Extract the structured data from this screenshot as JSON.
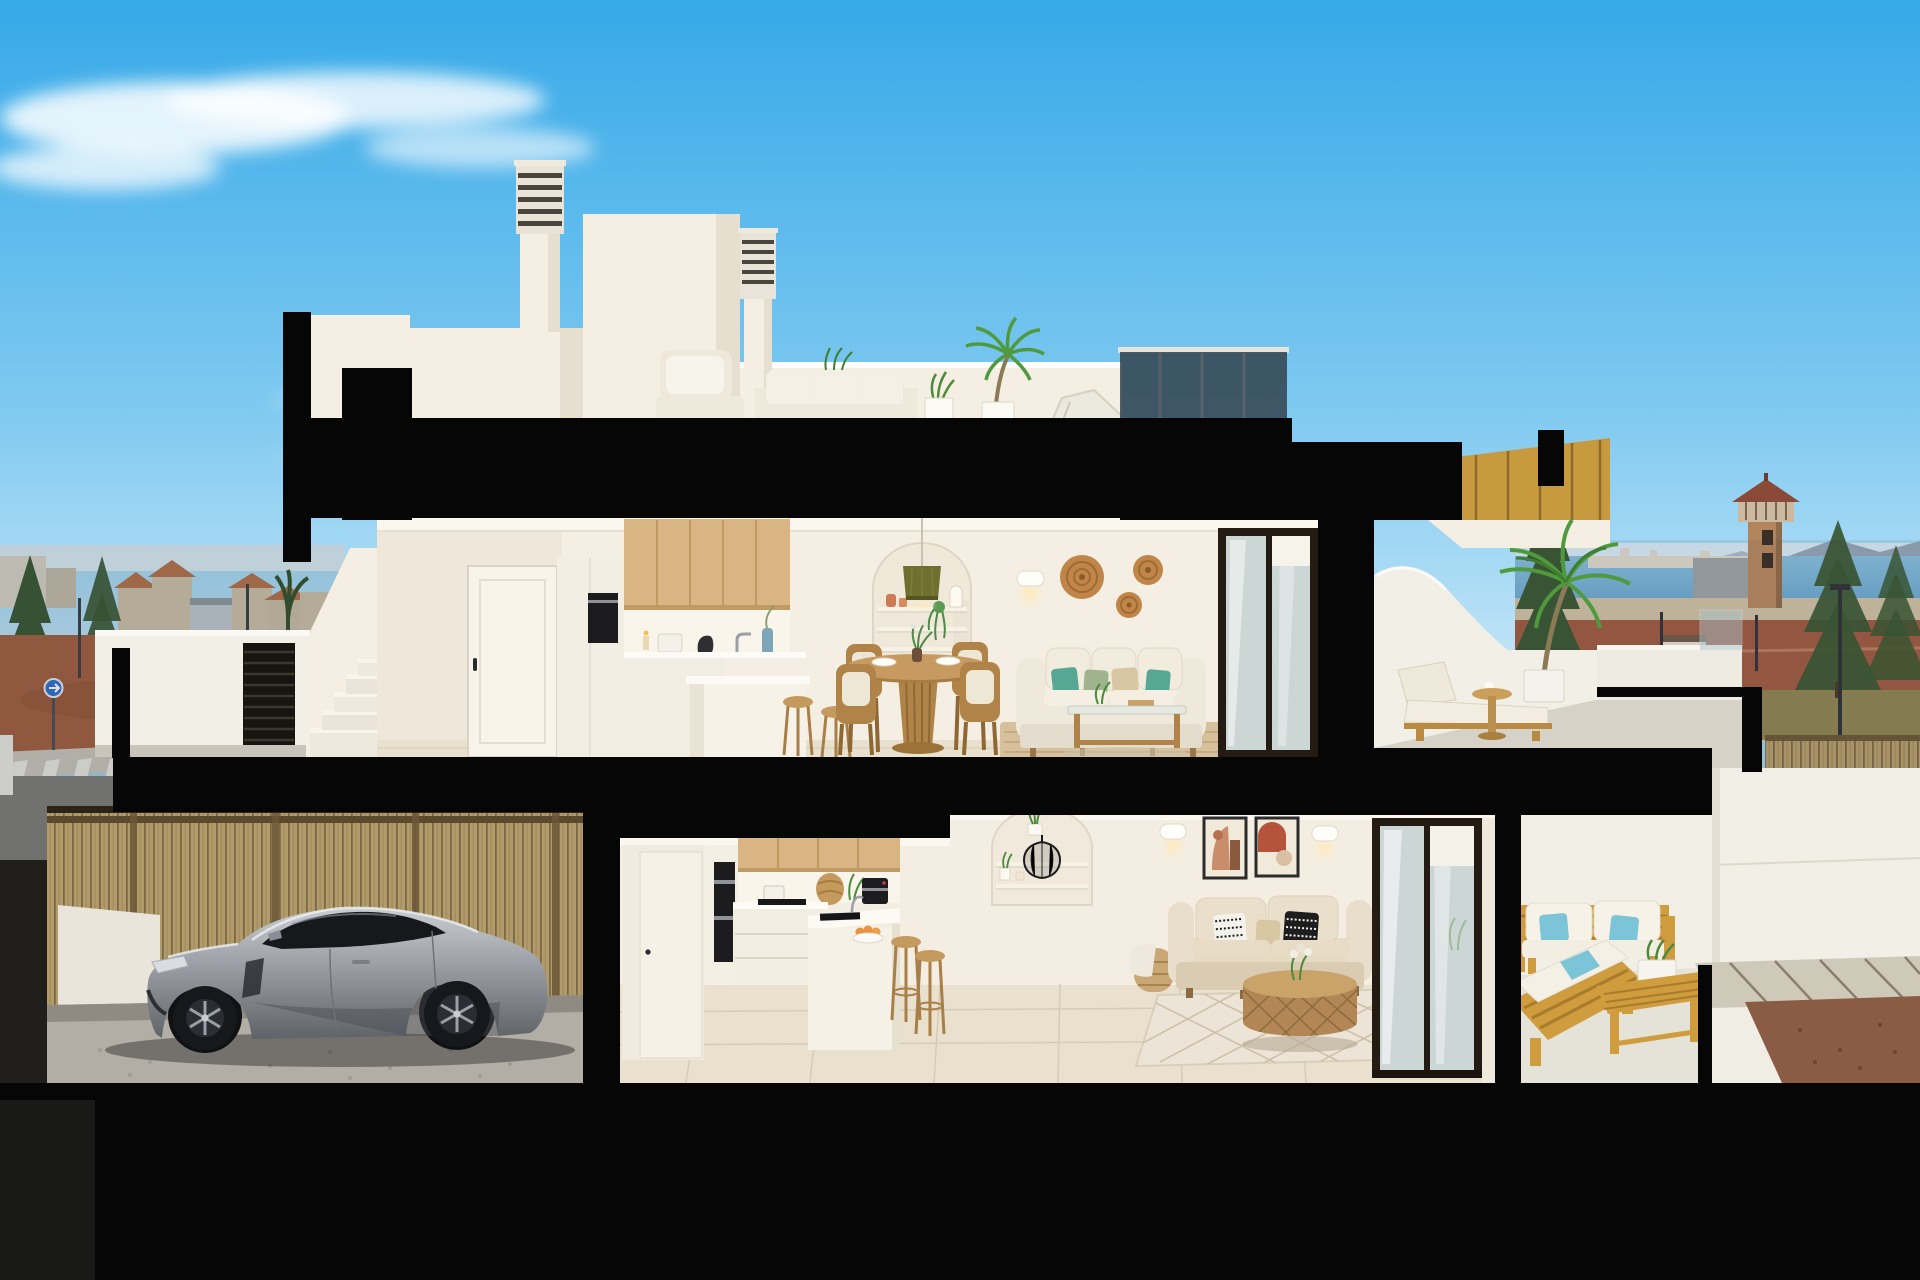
{
  "labels": {
    "scene": "3D cutaway section render of a modern two-storey duplex house at dusk",
    "sky": "blue sky with wispy clouds",
    "town_left": "town skyline with terracotta roofs, trees, street and crosswalk at left",
    "coast_right": "coast view with sea, mountains, watchtower, pines and street at right",
    "watchtower": "brick watchtower with balustrade and pyramid roof",
    "roof": "white roof volumes with louvered chimneys and roof terrace",
    "roof_terrace": "roof terrace with white outdoor sofas, plants and palm",
    "section": "black cut structure of the building section",
    "upper_floor": "upper apartment: kitchen, dining, living room",
    "upper_kitchen": "upper kitchen with oak wall cabinets, oven column and island",
    "upper_dining": "round wooden pedestal table with wooden chairs",
    "upper_living": "white sofa with teal pillows, arched niche, pendant lamp, wicker wall baskets",
    "upper_terrace": "upper terrace with curved parapet, sun lounger, side table and potted palm",
    "staircase": "external white staircase and parapet with louvered vent",
    "lower_floor": "lower apartment: kitchen, dining, living room",
    "garage": "garage with bamboo fence backdrop and silver sports car",
    "car": "silver sports coupe parked in the garage",
    "lower_kitchen": "lower kitchen with oak cabinets, double oven, peninsula and stools",
    "lower_dining": "glass dining table with four brown chairs",
    "lower_living": "beige sofa with black and white pillows, rattan coffee table, framed abstract art",
    "lower_terrace": "ground-floor terrace with yellow wooden lounge set and bench table",
    "ground": "dark ground base of the section with pavers and gravel at right"
  },
  "inventory": {
    "roof_terrace": [
      "louvered chimney",
      "louvered chimney",
      "white outdoor armchair",
      "white outdoor sofa",
      "potted plants",
      "palm in white planter",
      "lounge chair",
      "dark glass balustrade",
      "wooden stair soffit"
    ],
    "upper_floor": [
      "white interior door",
      "oak upper cabinets",
      "built-in oven",
      "kitchen island with stools",
      "blue vase",
      "round wood dining table",
      "4 wooden chairs",
      "arched shelf niche",
      "olive pendant lamp",
      "wall sconce",
      "3 wicker wall plates",
      "white sofa with teal pillows",
      "wood-glass coffee table",
      "jute rug",
      "dark framed sliding glass door"
    ],
    "upper_terrace": [
      "curved white parapet",
      "wooden sun lounger",
      "pedestal side table",
      "potted palm",
      "glass railing"
    ],
    "lower_floor": [
      "white door",
      "double oven column",
      "oak cabinets",
      "induction hob with pot",
      "coffee machine",
      "wicker basket",
      "peninsula with sink and orange bowl",
      "2 wooden stools",
      "glass dining table",
      "4 brown chairs",
      "arched niche with wire lantern",
      "2 framed abstract artworks",
      "2 wall sconces",
      "beige sofa",
      "basket side table",
      "rattan drum coffee table",
      "diamond pattern rug",
      "sliding glass door"
    ],
    "garage": [
      "bamboo slat fence",
      "white side wall",
      "silver sports coupe",
      "cobbled floor"
    ],
    "lower_terrace": [
      "yellow wood loveseat with white cushions",
      "light blue pillows",
      "yellow wood chaise",
      "slatted bench table with planter"
    ],
    "background": [
      "wispy cloud",
      "town skyline",
      "conifer trees",
      "palm silhouettes",
      "street sign",
      "crosswalk",
      "sea",
      "mountains",
      "watchtower",
      "street lamps",
      "reed fence",
      "paver driveway",
      "gravel patch"
    ]
  },
  "colors": {
    "sky-top": "#36a9e8",
    "sky-mid": "#7cc8f0",
    "sky-low": "#cfeaf8",
    "cloud": "#ffffff",
    "cut": "#060606",
    "wall": "#f5efe3",
    "wall-sh": "#e6dfcf",
    "ceil": "#fbf7ee",
    "floor": "#e9e1ce",
    "floor-line": "#d5ccb7",
    "wood-cab": "#d8b583",
    "wood-line": "#bf9a60",
    "wood-furn": "#b08449",
    "wood-out": "#cf9c3e",
    "wood-out-dark": "#a87c2c",
    "sofa-white": "#efe9db",
    "sofa-beige": "#e6dac3",
    "teal": "#57a795",
    "sage": "#9fb38e",
    "beige-pillow": "#d9c7a4",
    "blue-pillow": "#7cc5d8",
    "rattan": "#b28755",
    "rug-jute": "#d7c19d",
    "rug-low": "#ece4d6",
    "rug-line": "#cbbfa8",
    "frame-dark": "#241b12",
    "glass": "#ccd6d4",
    "terr-wall": "#f2efe7",
    "terr-floor": "#d6d2c7",
    "palm": "#4f9a3c",
    "conifer": "#3a5733",
    "town": "#cdbfa8",
    "roof-tile": "#b4714b",
    "haze": "#e3ecf2",
    "sea": "#6aa6cd",
    "mountain": "#8b9aae",
    "tower-brick": "#b3855e",
    "tower-roof": "#8a4a38",
    "dirt": "#a2603f",
    "road": "#7e7c78",
    "walk": "#c9c4b8",
    "red-road": "#9c5a40",
    "field": "#8c8252",
    "paver": "#cfc9ba",
    "gravel": "#8a5c43",
    "bamboo": "#b29b6b",
    "bamboo-dark": "#7c6844",
    "car-hi": "#c9ccd0",
    "car-mid": "#9a9ea4",
    "car-lo": "#5f6368",
    "car-window": "#16181c",
    "wheel": "#17181b",
    "rim": "#9aa0a6",
    "garage-floor": "#b2aea6",
    "oven": "#1c1c1e",
    "steel": "#8f9296",
    "olive": "#6f7030",
    "terracotta": "#cd7a55",
    "art-frame": "#2b2b2b",
    "basket": "#c08548",
    "glow": "#ffe9b8"
  }
}
